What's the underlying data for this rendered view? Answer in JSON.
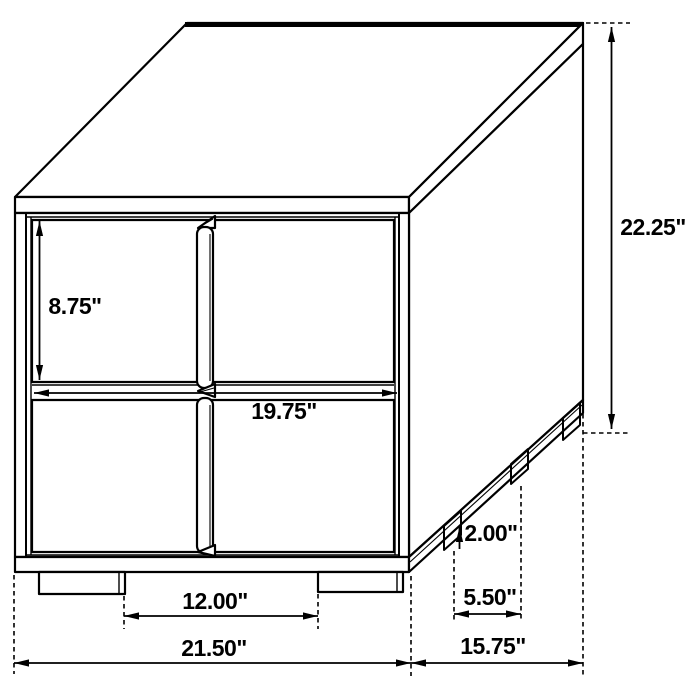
{
  "diagram": {
    "type": "furniture-dimension-diagram",
    "subject": "two-drawer-nightstand-line-drawing",
    "colors": {
      "ink": "#000000",
      "background": "#ffffff"
    },
    "unit": "inches",
    "dimensions": [
      {
        "name": "drawer-front-height",
        "label": "8.75\"",
        "line": {
          "x1": 39.5,
          "y1": 221,
          "x2": 39.5,
          "y2": 380,
          "arrow_start": true,
          "arrow_end": true
        },
        "label_pos": {
          "x": 75,
          "y": 306
        },
        "extensions": []
      },
      {
        "name": "overall-height",
        "label": "22.25\"",
        "line": {
          "x1": 611.5,
          "y1": 27,
          "x2": 611.5,
          "y2": 429,
          "arrow_start": true,
          "arrow_end": true
        },
        "label_pos": {
          "x": 653,
          "y": 227
        },
        "extensions": [
          [
            586,
            23,
            630,
            23
          ],
          [
            583,
            433,
            628,
            433
          ]
        ]
      },
      {
        "name": "drawer-front-width",
        "label": "19.75\"",
        "line": {
          "x1": 34,
          "y1": 393,
          "x2": 397,
          "y2": 393,
          "arrow_start": true,
          "arrow_end": true
        },
        "label_pos": {
          "x": 284,
          "y": 411
        },
        "extensions": []
      },
      {
        "name": "foot-height",
        "label": "2.00\"",
        "line": {
          "x1": 459.5,
          "y1": 527,
          "x2": 459.5,
          "y2": 549,
          "arrow_start": true,
          "arrow_end": false
        },
        "label_pos": {
          "x": 491,
          "y": 533
        },
        "extensions": []
      },
      {
        "name": "side-foot-spacing",
        "label": "5.50\"",
        "line": {
          "x1": 454,
          "y1": 614,
          "x2": 521,
          "y2": 614,
          "arrow_start": true,
          "arrow_end": true
        },
        "label_pos": {
          "x": 490,
          "y": 597
        },
        "extensions": [
          [
            454,
            551,
            454,
            622
          ],
          [
            521,
            486,
            521,
            622
          ]
        ]
      },
      {
        "name": "front-foot-spacing",
        "label": "12.00\"",
        "line": {
          "x1": 124,
          "y1": 616,
          "x2": 318,
          "y2": 616,
          "arrow_start": true,
          "arrow_end": true
        },
        "label_pos": {
          "x": 215,
          "y": 601
        },
        "extensions": [
          [
            124,
            596,
            124,
            629
          ],
          [
            318,
            594,
            318,
            629
          ]
        ]
      },
      {
        "name": "overall-width",
        "label": "21.50\"",
        "line": {
          "x1": 14,
          "y1": 663,
          "x2": 411,
          "y2": 663,
          "arrow_start": true,
          "arrow_end": true
        },
        "label_pos": {
          "x": 214,
          "y": 648
        },
        "extensions": [
          [
            14,
            575,
            14,
            674
          ]
        ]
      },
      {
        "name": "overall-depth",
        "label": "15.75\"",
        "line": {
          "x1": 411,
          "y1": 663,
          "x2": 583,
          "y2": 663,
          "arrow_start": true,
          "arrow_end": true
        },
        "label_pos": {
          "x": 493,
          "y": 646
        },
        "extensions": [
          [
            411,
            576,
            411,
            676
          ],
          [
            583,
            406,
            583,
            676
          ]
        ]
      }
    ]
  }
}
